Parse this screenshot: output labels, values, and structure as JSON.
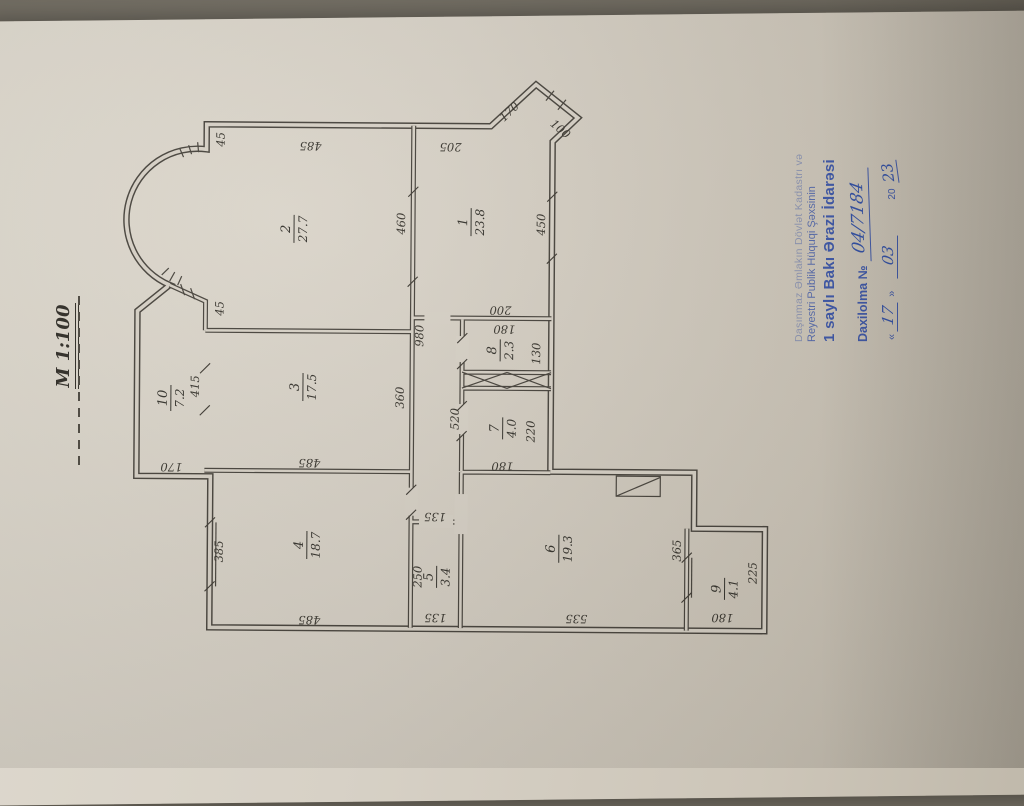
{
  "scale_label": "M 1:100",
  "stamp": {
    "line1": "Daşınmaz Əmlakın Dövlət Kadastrı və",
    "line2": "Reyestri Publik Hüquqi Şəxsinin",
    "line3": "1 saylı Bakı Ərazi İdarəsi",
    "entry_label": "Daxilolma №",
    "entry_number": "04/7184",
    "quote_open": "«",
    "quote_close": "»",
    "date_day": "17",
    "date_month": "03",
    "date_century": "20",
    "date_year": "23"
  },
  "plan": {
    "rooms": [
      {
        "number": "1",
        "area": "23.8"
      },
      {
        "number": "2",
        "area": "27.7"
      },
      {
        "number": "3",
        "area": "17.5"
      },
      {
        "number": "4",
        "area": "18.7"
      },
      {
        "number": "5",
        "area": "3.4"
      },
      {
        "number": "6",
        "area": "19.3"
      },
      {
        "number": "7",
        "area": "4.0"
      },
      {
        "number": "8",
        "area": "2.3"
      },
      {
        "number": "9",
        "area": "4.1"
      },
      {
        "number": "10",
        "area": "7.2"
      }
    ],
    "dimensions": [
      "45",
      "485",
      "205",
      "170",
      "100",
      "460",
      "450",
      "200",
      "980",
      "45",
      "415",
      "360",
      "520",
      "130",
      "180",
      "220",
      "180",
      "170",
      "485",
      "385",
      "485",
      "135",
      "250",
      "135",
      "535",
      "365",
      "225",
      "180"
    ]
  },
  "colors": {
    "paper": "#d7d1c6",
    "plan_line": "#45413a",
    "stamp_blue": "#3a55a9",
    "handwriting_blue": "#2d4da6"
  }
}
